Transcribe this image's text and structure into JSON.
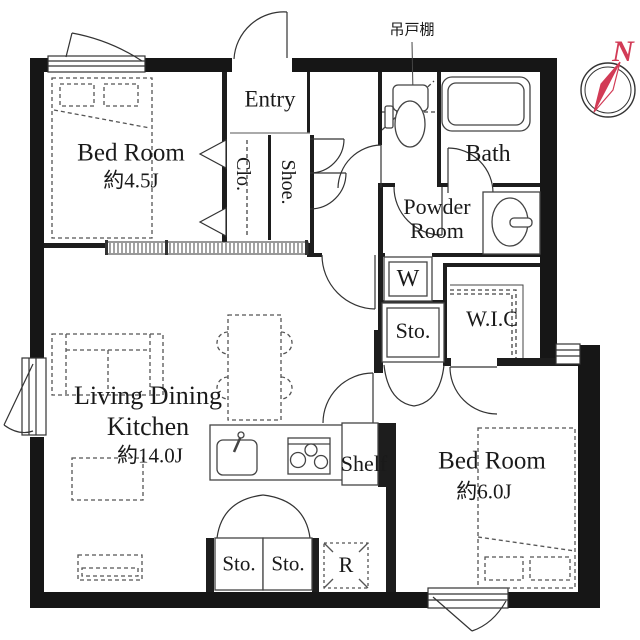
{
  "plan": {
    "north_label": "N",
    "annotations": {
      "hanging_cupboard": "吊戸棚"
    },
    "rooms": {
      "entry": "Entry",
      "bedroom1": {
        "name": "Bed Room",
        "size": "約4.5J"
      },
      "closet": "Clo.",
      "shoe": "Shoe.",
      "bath": "Bath",
      "powder": {
        "line1": "Powder",
        "line2": "Room"
      },
      "washer": "W",
      "storage_mid": "Sto.",
      "wic": "W.I.C",
      "ldk": {
        "line1": "Living Dining",
        "line2": "Kitchen",
        "size": "約14.0J"
      },
      "shelf": "Shelf",
      "bedroom2": {
        "name": "Bed Room",
        "size": "約6.0J"
      },
      "storage_bottom1": "Sto.",
      "storage_bottom2": "Sto.",
      "refrigerator": "R"
    },
    "colors": {
      "wall": "#161616",
      "compass_red": "#d23b56"
    }
  }
}
